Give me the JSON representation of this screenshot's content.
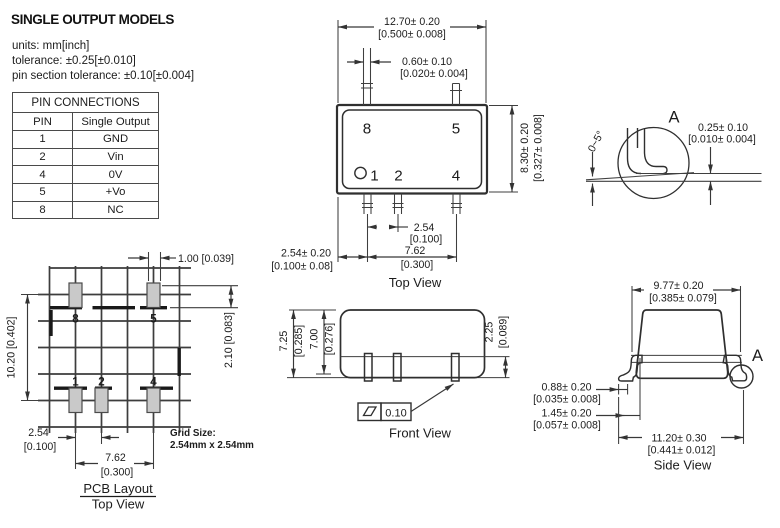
{
  "header": {
    "title": "SINGLE OUTPUT MODELS",
    "line1": "units: mm[inch]",
    "line2": "tolerance: ±0.25[±0.010]",
    "line3": "pin section tolerance: ±0.10[±0.004]"
  },
  "pin_table": {
    "title": "PIN CONNECTIONS",
    "headers": [
      "PIN",
      "Single Output"
    ],
    "rows": [
      [
        "1",
        "GND"
      ],
      [
        "2",
        "Vin"
      ],
      [
        "4",
        "0V"
      ],
      [
        "5",
        "+Vo"
      ],
      [
        "8",
        "NC"
      ]
    ]
  },
  "top_view": {
    "label": "Top View",
    "pin8": "8",
    "pin5": "5",
    "pin1": "1",
    "pin2": "2",
    "pin4": "4",
    "dim_width": "12.70± 0.20",
    "dim_width_in": "[0.500± 0.008]",
    "dim_pin": "0.60± 0.10",
    "dim_pin_in": "[0.020± 0.004]",
    "dim_height": "8.30± 0.20",
    "dim_height_in": "[0.327± 0.008]",
    "dim_pitch": "2.54",
    "dim_pitch_in": "[0.100]",
    "dim_span": "7.62",
    "dim_span_in": "[0.300]",
    "dim_offset": "2.54± 0.20",
    "dim_offset_in": "[0.100± 0.08]"
  },
  "detail_a": {
    "label": "A",
    "angle": "0~5°",
    "dim": "0.25± 0.10",
    "dim_in": "[0.010± 0.004]"
  },
  "pcb": {
    "title": "PCB Layout",
    "subtitle": "Top View",
    "grid_note_1": "Grid Size:",
    "grid_note_2": "2.54mm x 2.54mm",
    "pin8": "8",
    "pin5": "5",
    "pin1": "1",
    "pin2": "2",
    "pin4": "4",
    "dim_pad": "1.00 [0.039]",
    "dim_height": "10.20 [0.402]",
    "dim_edge": "2.10 [0.083]",
    "dim_pitch": "2.54",
    "dim_pitch_in": "[0.100]",
    "dim_span": "7.62",
    "dim_span_in": "[0.300]"
  },
  "front_view": {
    "label": "Front View",
    "dim_h1": "7.25",
    "dim_h1_in": "[0.285]",
    "dim_h2": "7.00",
    "dim_h2_in": "[0.276]",
    "dim_standoff": "2.25",
    "dim_standoff_in": "[0.089]",
    "flatness": "0.10"
  },
  "side_view": {
    "label": "Side View",
    "detail_ref": "A",
    "dim_top": "9.77± 0.20",
    "dim_top_in": "[0.385± 0.079]",
    "dim_foot": "0.88± 0.20",
    "dim_foot_in": "[0.035± 0.008]",
    "dim_lead": "1.45± 0.20",
    "dim_lead_in": "[0.057± 0.008]",
    "dim_total": "11.20± 0.30",
    "dim_total_in": "[0.441± 0.012]"
  }
}
